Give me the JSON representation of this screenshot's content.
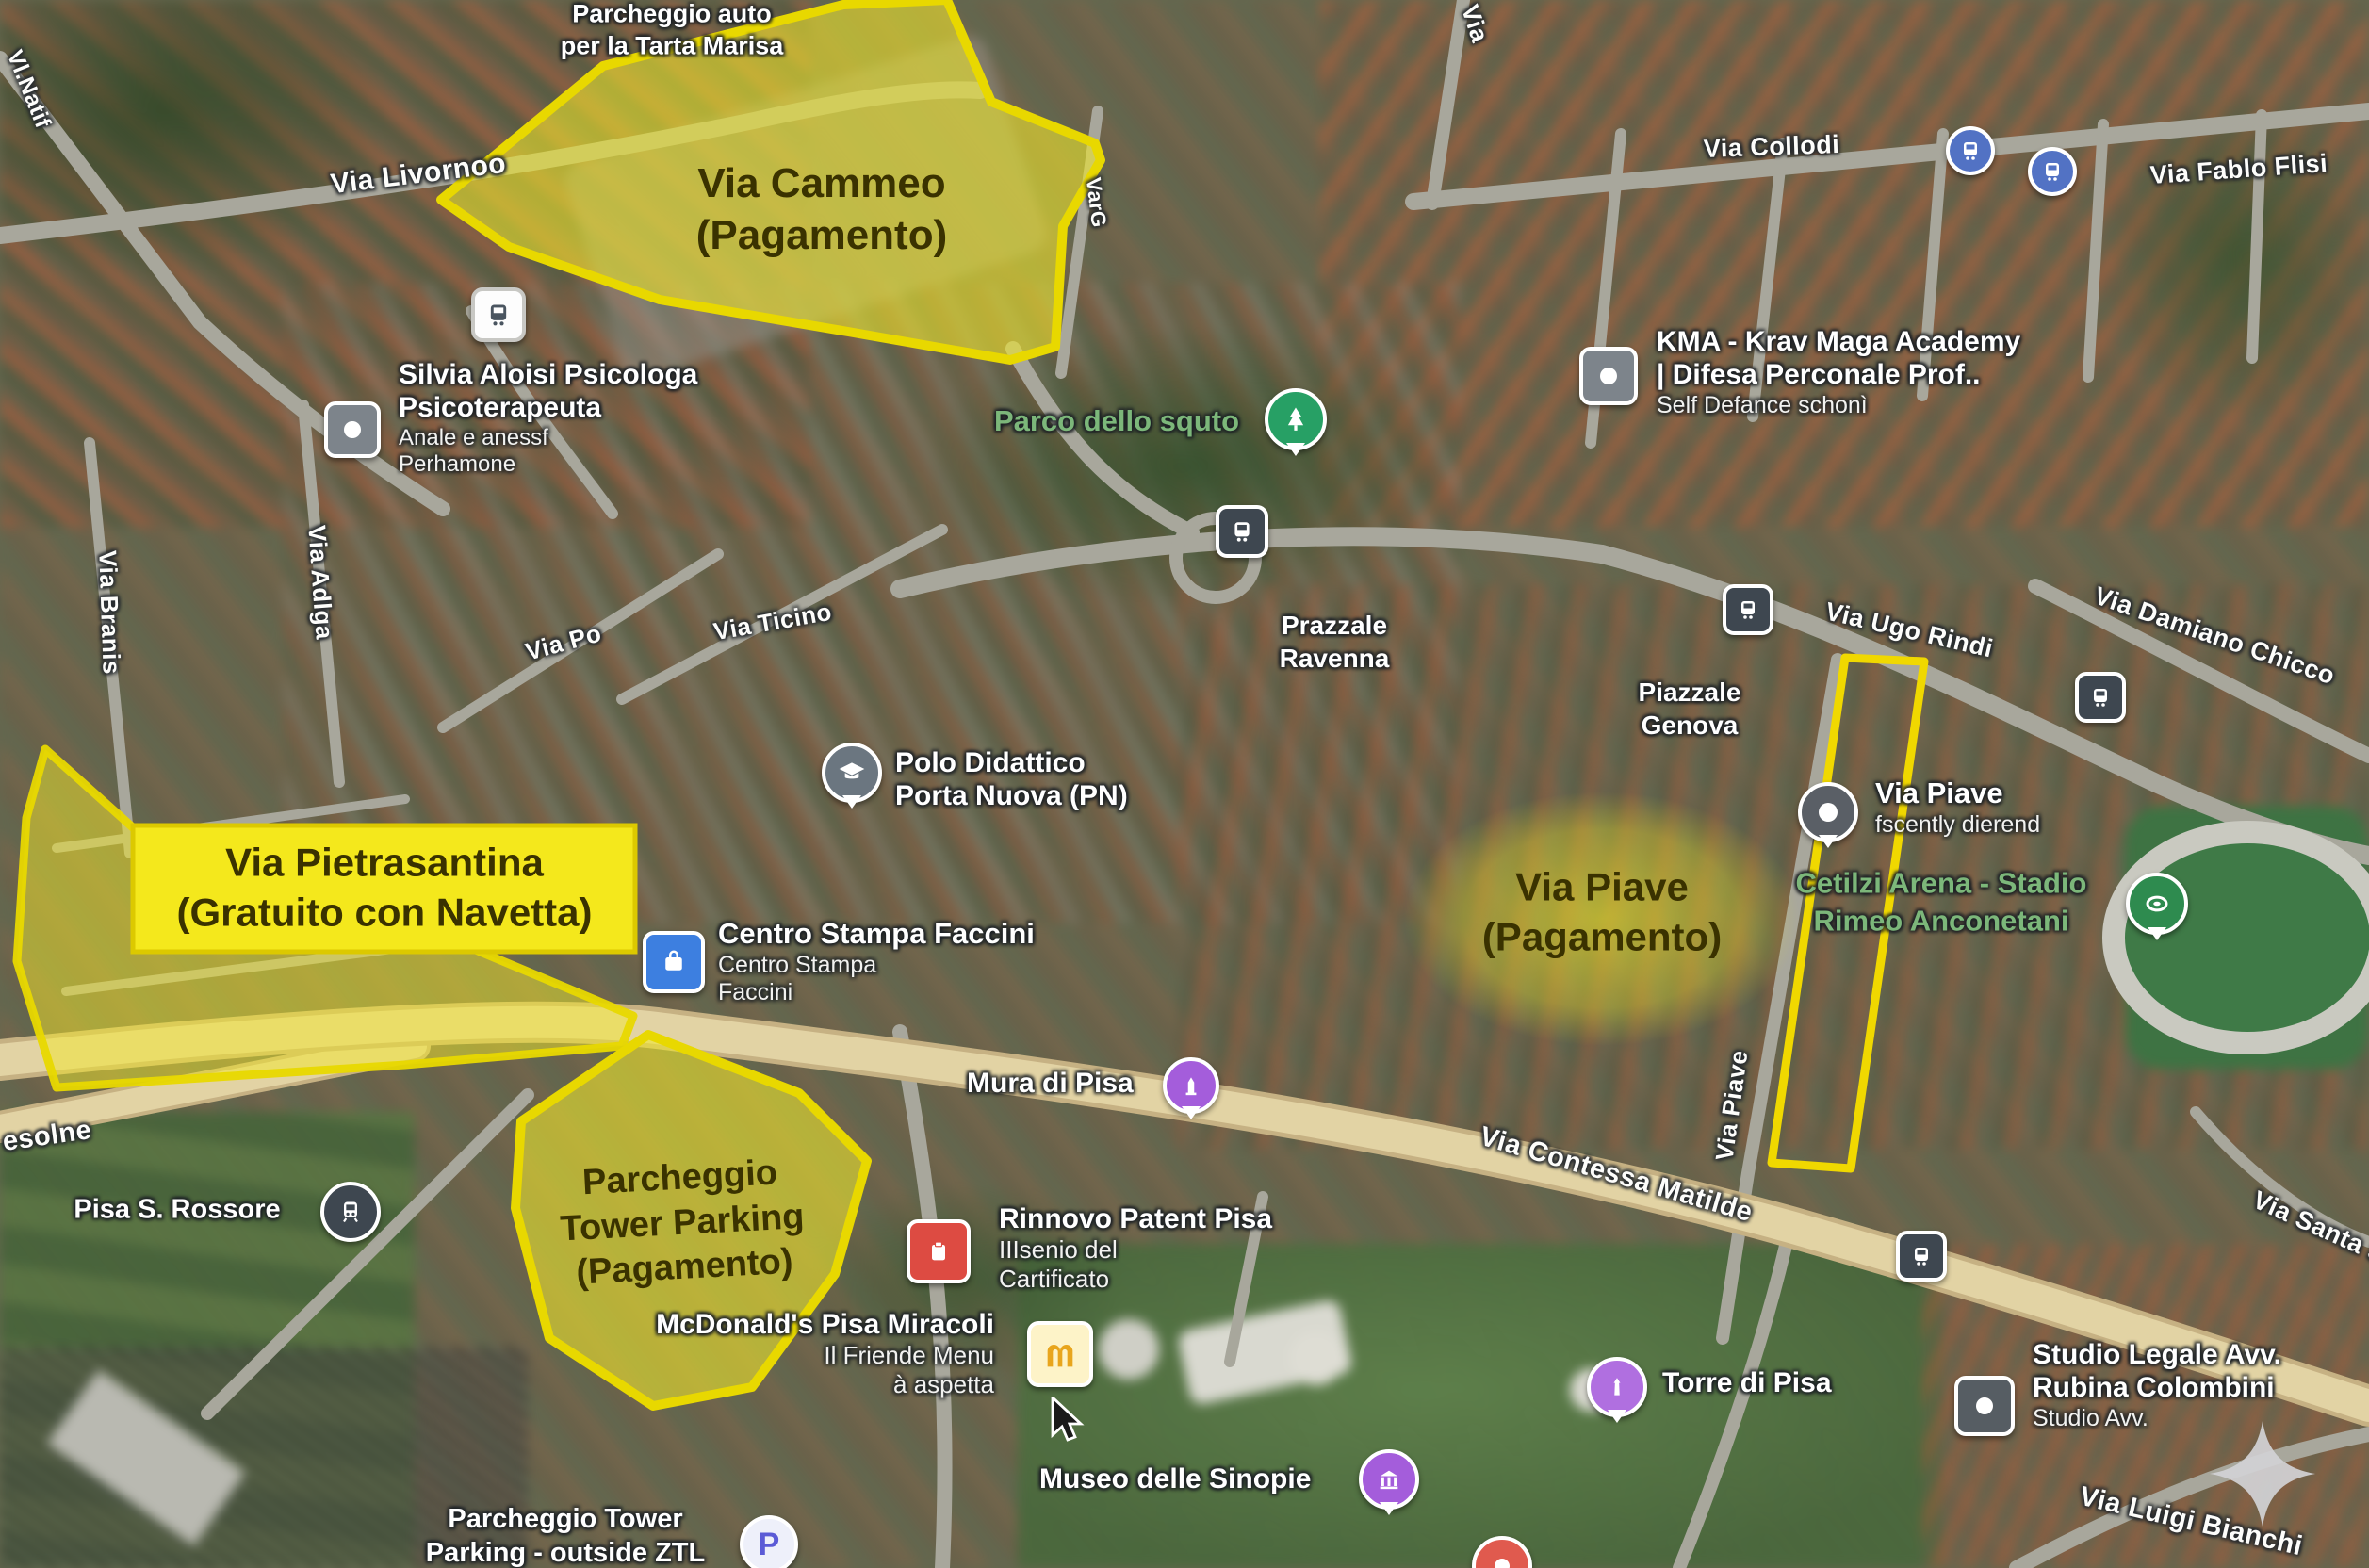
{
  "colors": {
    "annotation_yellow": "#f2e71c",
    "annotation_border": "#e8d800",
    "annotation_text": "#3a3200",
    "road_tan": "#e2d3a4",
    "road_gray": "#a8a79c",
    "green_label": "#7cb77a",
    "bus_blue": "#5272c4",
    "poi_purple": "#a express45ddb",
    "poi_red": "#dd4b42",
    "poi_green": "#27a065",
    "mcdonalds_gold": "#e8a51d"
  },
  "annotations": {
    "cammeo": {
      "line1": "Via Cammeo",
      "line2": "(Pagamento)"
    },
    "pietrasantina": {
      "line1": "Via Pietrasantina",
      "line2": "(Gratuito con Navetta)"
    },
    "tower": {
      "line1": "Parcheggio",
      "line2": "Tower Parking",
      "line3": "(Pagamento)"
    },
    "piave": {
      "line1": "Via Piave",
      "line2": "(Pagamento)"
    }
  },
  "streets": {
    "livorno": "Via Livornoo",
    "nati": "Vl.Natif",
    "brana": "Via Branis",
    "adlga": "Via Adlga",
    "po": "Via Po",
    "ticino": "Via Ticino",
    "varg": "VarG",
    "via_top": "Via",
    "collodi": "Via Collodi",
    "fablo": "Via Fablo Flisi",
    "ugo": "Via Ugo Rindi",
    "damiano": "Via Damiano Chicco",
    "contessa": "Via Contessa Matilde",
    "piave_road": "Via Piave",
    "esolne": "esolne",
    "santa": "Via Santa St",
    "luigi": "Via Luigi Bianchi"
  },
  "areas": {
    "tarta1": "Parcheggio auto",
    "tarta2": "per la Tarta Marisa",
    "prazzale1": "Prazzale",
    "prazzale2": "Ravenna",
    "genova1": "Piazzale",
    "genova2": "Genova",
    "ztl1": "Parcheggio Tower",
    "ztl2": "Parking - outside ZTL",
    "rossore": "Pisa S. Rossore"
  },
  "pois": {
    "silvia": {
      "line1": "Silvia Aloisi Psicologa",
      "line2": "Psicoterapeuta",
      "line3": "Anale e anessf",
      "line4": "Perhamone"
    },
    "parco": {
      "name": "Parco dello squto"
    },
    "kma": {
      "line1": "KMA - Krav Maga Academy",
      "line2": "| Difesa Perconale Prof..",
      "line3": "Self Defance schonì"
    },
    "polo": {
      "line1": "Polo Didattico",
      "line2": "Porta Nuova (PN)"
    },
    "centro": {
      "line1": "Centro Stampa Faccini",
      "line2": "Centro Stampa",
      "line3": "Faccini"
    },
    "piave_poi": {
      "line1": "Via Piave",
      "line2": "fscently dierend"
    },
    "arena": {
      "line1": "Cetilzi Arena - Stadio",
      "line2": "Rimeo Anconetani"
    },
    "mura": {
      "name": "Mura di Pisa"
    },
    "mcdonalds": {
      "line1": "McDonald's Pisa Miracoli",
      "line2": "Il Friende Menu",
      "line3": "à aspetta"
    },
    "rinnovo": {
      "line1": "Rinnovo Patent Pisa",
      "line2": "IIIsenio del",
      "line3": "Cartificato"
    },
    "museo": {
      "name": "Museo delle Sinopie"
    },
    "torre": {
      "name": "Torre di Pisa"
    },
    "studio": {
      "line1": "Studio Legale Avv.",
      "line2": "Rubina Colombini",
      "line3": "Studio Avv."
    }
  },
  "icons": {
    "bus": "bus-icon",
    "train": "train-icon",
    "tree": "tree-pin-icon",
    "school": "school-pin-icon",
    "shopping": "shopping-bag-icon",
    "dot": "dot-pin-icon",
    "stadium": "stadium-pin-icon",
    "tower": "tower-pin-icon",
    "museum": "museum-pin-icon",
    "license": "license-icon",
    "mcdonalds": "mcdonalds-m-icon",
    "parking": "parking-p-icon",
    "poi_square": "poi-square-icon",
    "sparkle": "sparkle-icon",
    "cursor": "mouse-cursor-icon"
  }
}
